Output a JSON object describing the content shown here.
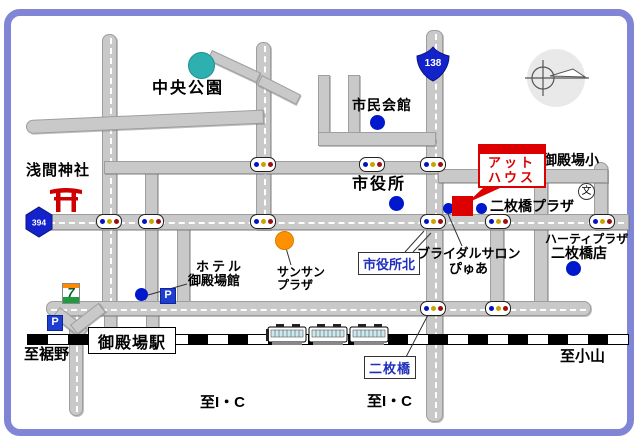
{
  "frame": {
    "border_color": "#8085d6",
    "background": "#ffffff"
  },
  "route_badges": {
    "national_138": "138",
    "prefectural_394": "394"
  },
  "labels": {
    "central_park": "中央公園",
    "civic_hall": "市民会館",
    "sengen_shrine": "浅間神社",
    "city_hall": "市役所",
    "gotemba_elementary": "御殿場小",
    "nimaibashi_plaza": "二枚橋プラザ",
    "hearty_plaza_line1": "ハーティプラザ",
    "hearty_plaza_line2": "二枚橋店",
    "bridal_salon_line1": "ブライダルサロン",
    "bridal_salon_line2": "ぴゅあ",
    "sansan_plaza_line1": "サンサン",
    "sansan_plaza_line2": "プラザ",
    "hotel_line1": "ホテル",
    "hotel_line2": "御殿場館",
    "at_house_line1": "アット",
    "at_house_line2": "ハウス"
  },
  "station": {
    "gotemba_station": "御殿場駅"
  },
  "intersection_boxes": {
    "shiyakusho_kita": "市役所北",
    "nimaibashi": "二枚橋"
  },
  "directions": {
    "to_susono": "至裾野",
    "to_oyama": "至小山",
    "to_ic_left": "至I・C",
    "to_ic_right": "至I・C"
  },
  "icons": {
    "school_char": "文",
    "parking_char": "P",
    "convenience_char": "7"
  },
  "marker_colors": {
    "poi_blue": "#0018cc",
    "park_teal": "#2eb0b0",
    "sansan_orange": "#ff9100",
    "destination_red": "#dd0000"
  }
}
